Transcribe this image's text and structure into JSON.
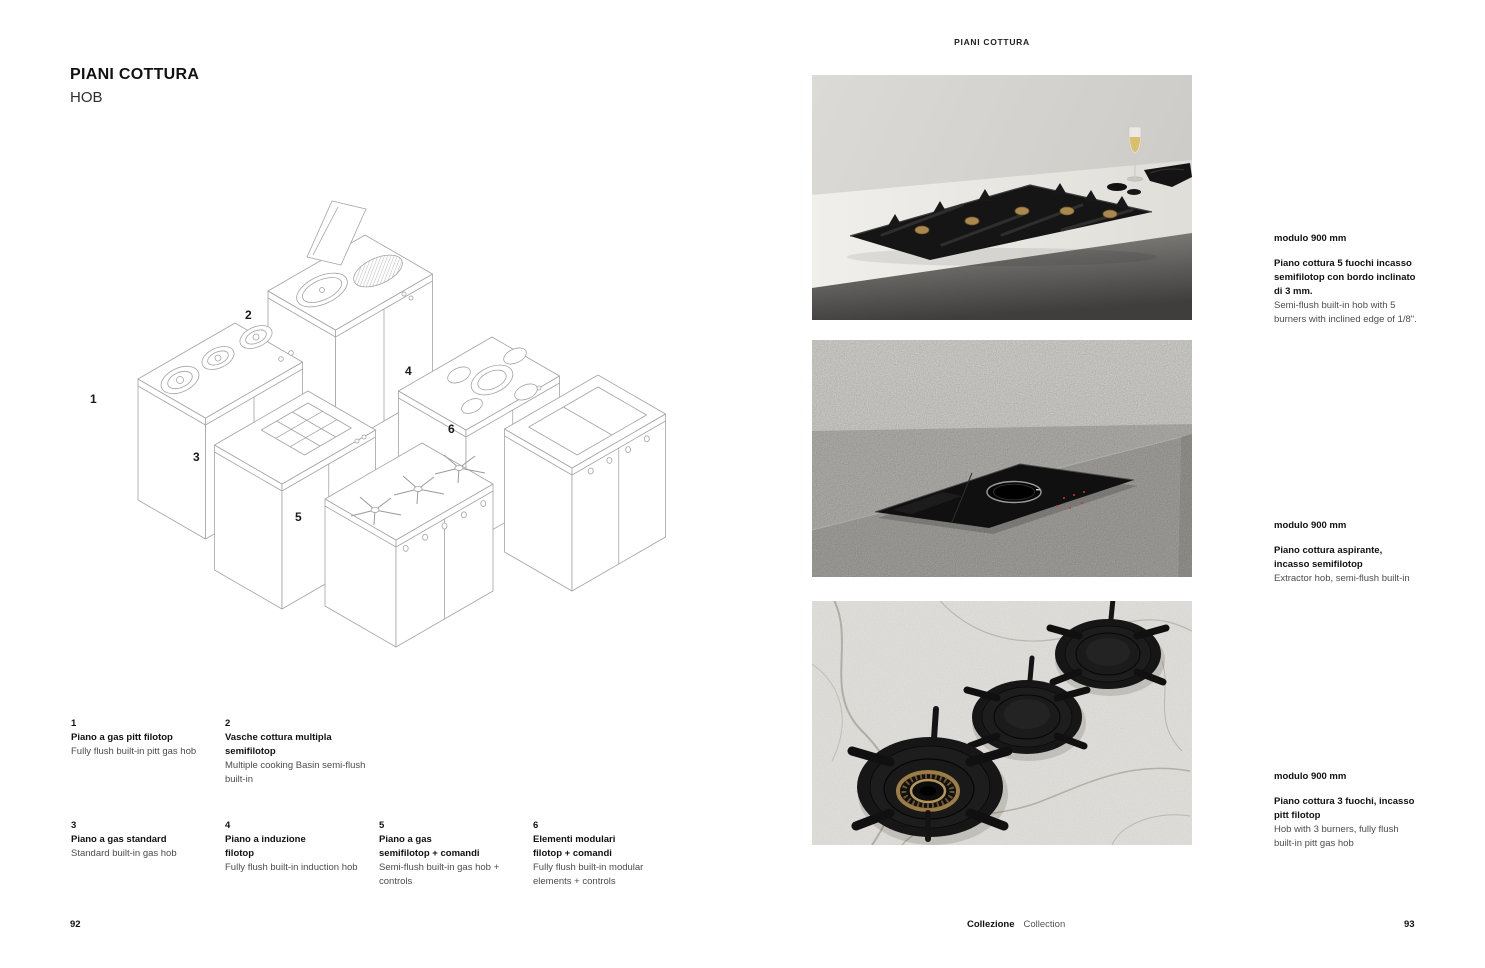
{
  "page": {
    "header_right": "PIANI COTTURA",
    "left_page_number": "92",
    "right_page_number": "93",
    "footer_brand_it": "Collezione",
    "footer_brand_en": "Collection"
  },
  "left": {
    "title": "PIANI COTTURA",
    "subtitle": "HOB",
    "diagram": {
      "labels": [
        "1",
        "2",
        "3",
        "4",
        "5",
        "6"
      ]
    },
    "legend": [
      {
        "num": "1",
        "title_it": "Piano a gas pitt filotop",
        "desc_en": "Fully flush built-in pitt gas hob"
      },
      {
        "num": "2",
        "title_it": "Vasche cottura multipla\nsemifilotop",
        "desc_en": "Multiple cooking Basin semi-flush\nbuilt-in"
      },
      {
        "num": "3",
        "title_it": "Piano a gas standard",
        "desc_en": "Standard built-in gas hob"
      },
      {
        "num": "4",
        "title_it": "Piano a induzione\nfilotop",
        "desc_en": "Fully flush built-in induction hob"
      },
      {
        "num": "5",
        "title_it": "Piano a gas\nsemifilotop + comandi",
        "desc_en": "Semi-flush built-in gas hob +\ncontrols"
      },
      {
        "num": "6",
        "title_it": "Elementi modulari\nfilotop + comandi",
        "desc_en": "Fully flush built-in modular\nelements + controls"
      }
    ]
  },
  "right": {
    "products": [
      {
        "module": "modulo 900 mm",
        "title_it": "Piano cottura 5 fuochi  incasso\nsemifilotop con bordo inclinato\ndi 3 mm.",
        "desc_en": "Semi-flush built-in hob with 5\nburners with inclined edge of 1/8\"."
      },
      {
        "module": "modulo 900 mm",
        "title_it": "Piano cottura aspirante,\nincasso semifilotop",
        "desc_en": "Extractor hob,  semi-flush built-in"
      },
      {
        "module": "modulo 900 mm",
        "title_it": "Piano cottura 3 fuochi, incasso\npitt filotop",
        "desc_en": "Hob with 3 burners, fully flush\nbuilt-in pitt gas hob"
      }
    ],
    "photos": [
      {
        "alt": "Semi-flush 5-burner gas hob with brass burners on grey worktop, glass of white wine"
      },
      {
        "alt": "Black extractor hob semi-flush built into concrete worktop"
      },
      {
        "alt": "Three black gas burners fully flush built into marble worktop"
      }
    ]
  },
  "colors": {
    "ink": "#1a1a1a",
    "muted_text": "#4c4c4c",
    "line_drawing": "#a3a3a3"
  }
}
